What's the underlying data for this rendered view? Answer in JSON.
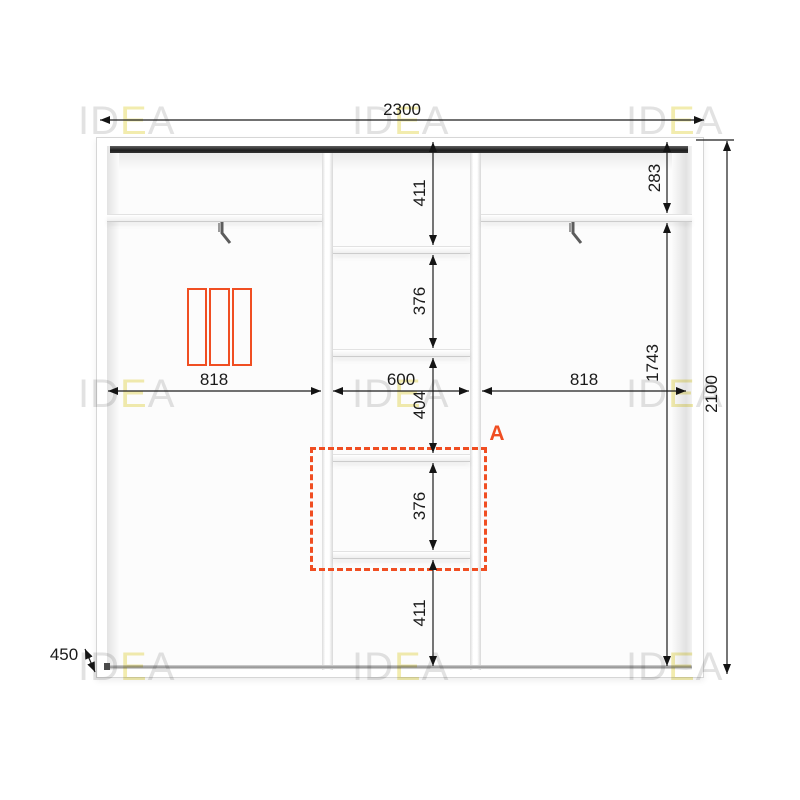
{
  "watermark": {
    "prefix": "ID",
    "accent_letter": "E",
    "suffix": "A"
  },
  "annotations": {
    "section_label": "A"
  },
  "dimensions": {
    "width_total": "2300",
    "height_total": "2100",
    "depth": "450",
    "left_section_width": "818",
    "middle_section_width": "600",
    "right_section_width": "818",
    "right_top_height": "283",
    "right_main_height": "1743",
    "middle_heights": [
      "411",
      "376",
      "404",
      "376",
      "411"
    ]
  },
  "colors": {
    "accent_orange": "#f04e22",
    "dimension_line": "#1c1c1c",
    "watermark_gray": "#e2e2e2",
    "watermark_yellow": "#f2ecae",
    "track_dark": "#1f1f1f"
  }
}
